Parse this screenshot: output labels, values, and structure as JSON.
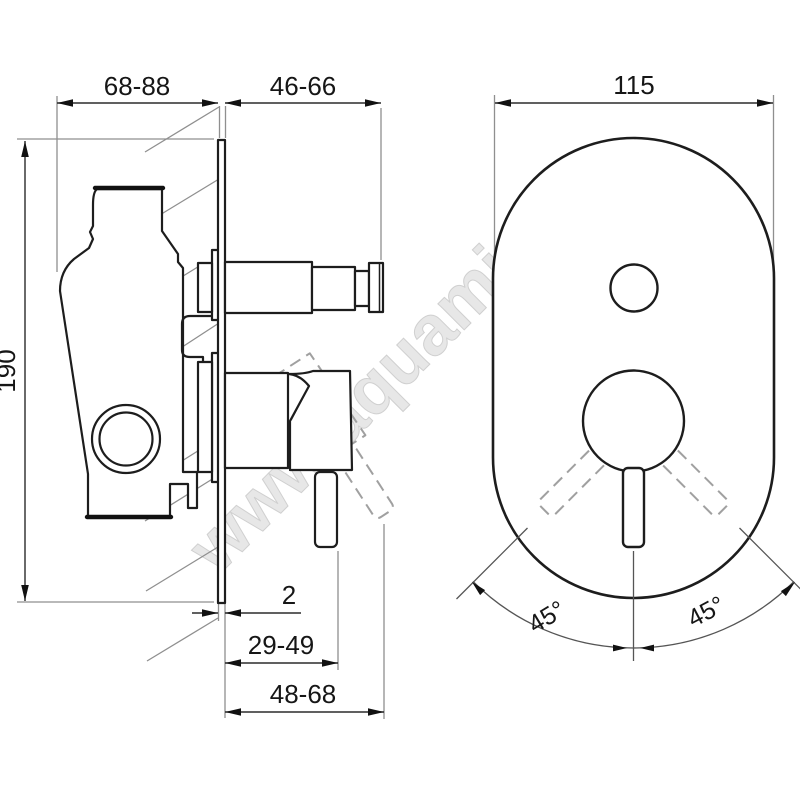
{
  "page": {
    "background": "#ffffff",
    "type": "technical-drawing",
    "subject": "concealed-mixer-valve"
  },
  "watermark": {
    "text": "www.aquamir.ru"
  },
  "dimensions": {
    "top_left": "68-88",
    "top_middle": "46-66",
    "top_right": "115",
    "left_vertical": "190",
    "plate_thickness": "2",
    "bottom_middle": "29-49",
    "bottom_wide": "48-68",
    "angle_left": "45°",
    "angle_right": "45°"
  },
  "colors": {
    "line": "#1d1d1d",
    "dimension_line": "#2b2b2b",
    "extension_line": "#8f8f8f",
    "dashed_position": "#a0a0a0",
    "watermark": "#e7e7e7",
    "background": "#ffffff"
  }
}
